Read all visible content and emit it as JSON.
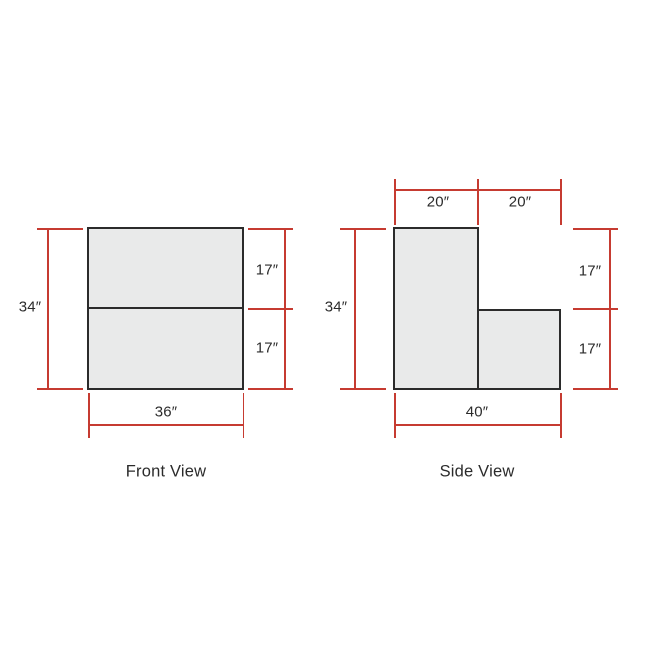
{
  "diagram": {
    "colors": {
      "dimension_line": "#c63b31",
      "shape_fill": "#e9eaea",
      "shape_border": "#2b2b2b",
      "text": "#2b2b2b",
      "background": "#ffffff"
    },
    "front_view": {
      "title": "Front View",
      "overall_height_label": "34″",
      "overall_width_label": "36″",
      "upper_section_label": "17″",
      "lower_section_label": "17″"
    },
    "side_view": {
      "title": "Side View",
      "overall_height_label": "34″",
      "overall_depth_label": "40″",
      "top_left_segment_label": "20″",
      "top_right_segment_label": "20″",
      "upper_section_label": "17″",
      "lower_section_label": "17″"
    }
  }
}
